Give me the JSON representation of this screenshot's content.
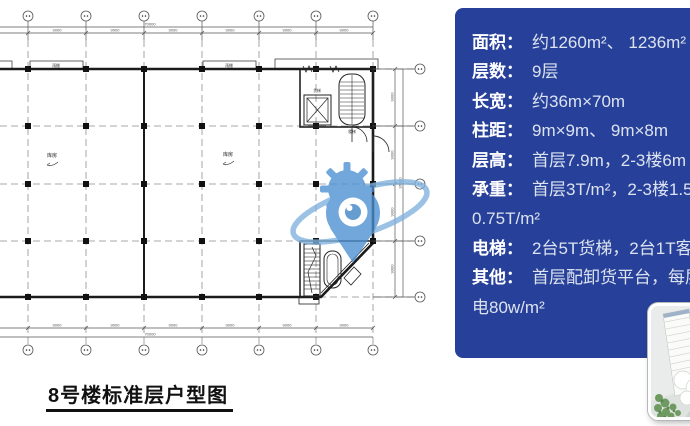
{
  "caption": "8号楼标准层户型图",
  "colors": {
    "panel_bg": "#27409a",
    "panel_label": "#ffffff",
    "panel_value": "#dce3ef",
    "watermark_blue": "#4a8fd2",
    "watermark_ring": "#7fb2de",
    "watermark_iris": "#3b82c4",
    "caption_color": "#111111"
  },
  "info_panel": {
    "rows": [
      {
        "label": "面积：",
        "value": "约1260m²、 1236m²"
      },
      {
        "label": "层数：",
        "value": "9层"
      },
      {
        "label": "长宽：",
        "value": "约36m×70m"
      },
      {
        "label": "柱距：",
        "value": "9m×9m、 9m×8m"
      },
      {
        "label": "层高：",
        "value": "首层7.9m，2-3楼6m"
      },
      {
        "label": "承重：",
        "value": "首层3T/m²，2-3楼1.5T/m²，",
        "cont": "0.75T/m²"
      },
      {
        "label": "电梯：",
        "value": "2台5T货梯，2台1T客梯"
      },
      {
        "label": "其他：",
        "value": "首层配卸货平台，每层供",
        "cont": "电80w/m²"
      }
    ]
  },
  "floor_plan": {
    "room_labels": [
      "库房",
      "库房"
    ],
    "canopy_labels": [
      "雨棚",
      "雨棚"
    ],
    "core_labels": {
      "elevator": "货梯",
      "stair": "楼梯"
    },
    "dims": {
      "top_segments": [
        "9000",
        "9000",
        "9000",
        "9000",
        "9000",
        "9000"
      ],
      "top_total": "70000",
      "bottom_segments": [
        "9000",
        "9000",
        "9000",
        "9000",
        "9000",
        "9000"
      ],
      "bottom_total": "70000",
      "right_segments": [
        "9000",
        "9000",
        "9000",
        "9000"
      ],
      "right_total": "36000"
    }
  }
}
